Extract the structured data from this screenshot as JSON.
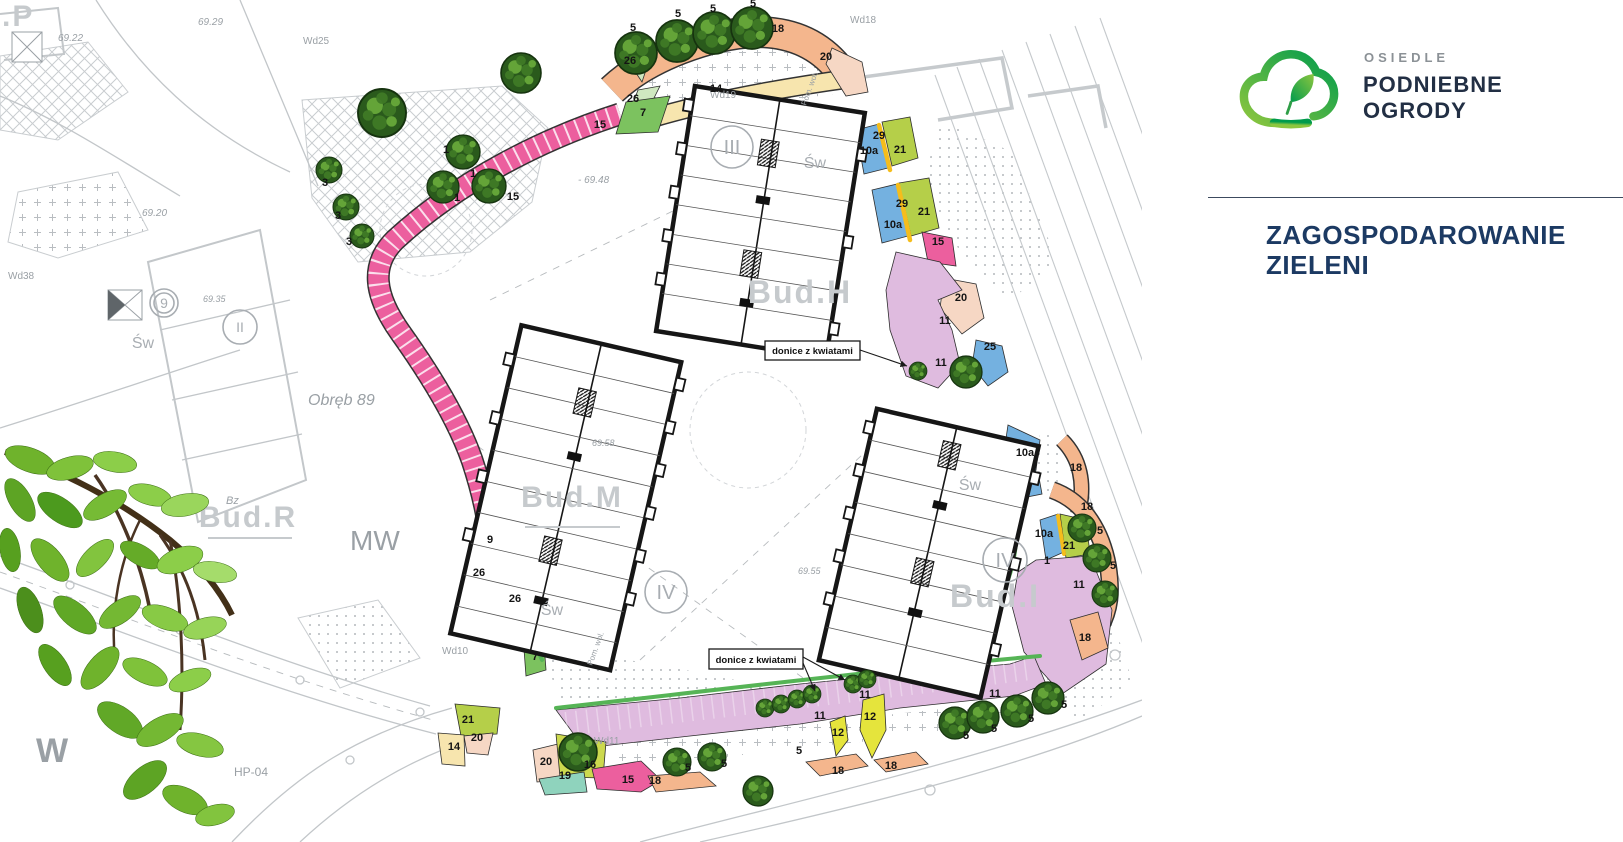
{
  "brand": {
    "estate_label": "OSIEDLE",
    "name_line1": "PODNIEBNE",
    "name_line2": "OGRODY",
    "title_line1": "ZAGOSPODAROWANIE",
    "title_line2": "ZIELENI",
    "colors": {
      "navy": "#222f44",
      "gray_text": "#8b9196",
      "title": "#1c3a63",
      "logo_green_light": "#8dc63f",
      "logo_green_dark": "#009b4c"
    }
  },
  "plan": {
    "sw_text": "Św",
    "zone_colors": {
      "7": "#7cc25f",
      "9": "#d6eedb",
      "10a": "#74b1e0",
      "11": "#dfbbdf",
      "12": "#e5e43c",
      "14": "#f7e5ae",
      "15": "#ec5f9e",
      "16": "#ccd94e",
      "18": "#f4b68d",
      "19": "#8fd3bd",
      "20": "#f6d7c4",
      "21": "#b5cf49",
      "25": "#74b1e0",
      "26": "#cfe8c0",
      "29": "#f5bd1c",
      "stripe_green": "#56b456"
    },
    "tree_colors": {
      "base": "#2a5a1c",
      "edge": "#16330f",
      "mid": "#3f7a26",
      "light": "#67a93a"
    },
    "building_labels": [
      {
        "t": "Bud.H",
        "x": 800,
        "y": 303,
        "s": 32
      },
      {
        "t": "Bud.M",
        "x": 572,
        "y": 507,
        "s": 30,
        "ul": [
          525,
          527,
          620,
          527
        ]
      },
      {
        "t": "Bud.I",
        "x": 995,
        "y": 607,
        "s": 32
      },
      {
        "t": "Bud.R",
        "x": 248,
        "y": 527,
        "s": 30,
        "ul": [
          208,
          538,
          292,
          538
        ]
      },
      {
        "t": "Bud.P",
        "x": -14,
        "y": 26,
        "s": 30,
        "st": 1
      }
    ],
    "circled_labels": [
      {
        "t": "III",
        "x": 732,
        "y": 147,
        "r": 21
      },
      {
        "t": "IV",
        "x": 666,
        "y": 592,
        "r": 21
      },
      {
        "t": "IV",
        "x": 1005,
        "y": 560,
        "r": 22
      },
      {
        "t": "II",
        "x": 240,
        "y": 327,
        "r": 17
      },
      {
        "t": "9",
        "x": 164,
        "y": 303,
        "r": 14
      }
    ],
    "sw_labels": [
      {
        "x": 815,
        "y": 168
      },
      {
        "x": 552,
        "y": 615
      },
      {
        "x": 970,
        "y": 490
      },
      {
        "x": 143,
        "y": 348
      }
    ],
    "gray_labels": [
      {
        "t": "69.22",
        "x": 58,
        "y": 41,
        "s": 10,
        "i": 1
      },
      {
        "t": "69.29",
        "x": 198,
        "y": 25,
        "s": 10,
        "i": 1
      },
      {
        "t": "69.20",
        "x": 142,
        "y": 216,
        "s": 10,
        "i": 1
      },
      {
        "t": "- 69.48",
        "x": 578,
        "y": 183,
        "s": 10,
        "i": 1
      },
      {
        "t": "69.35",
        "x": 203,
        "y": 302,
        "s": 9,
        "i": 1
      },
      {
        "t": "69.58",
        "x": 592,
        "y": 446,
        "s": 9,
        "i": 1
      },
      {
        "t": "69.55",
        "x": 798,
        "y": 574,
        "s": 9,
        "i": 1
      },
      {
        "t": "Wd25",
        "x": 303,
        "y": 44,
        "s": 10
      },
      {
        "t": "Wd38",
        "x": 8,
        "y": 279,
        "s": 10
      },
      {
        "t": "Wd18",
        "x": 850,
        "y": 23,
        "s": 10
      },
      {
        "t": "Wd19",
        "x": 710,
        "y": 98,
        "s": 10
      },
      {
        "t": "Wd10",
        "x": 442,
        "y": 654,
        "s": 10
      },
      {
        "t": "Wd11",
        "x": 594,
        "y": 744,
        "s": 10
      },
      {
        "t": "Obręb 89",
        "x": 308,
        "y": 405,
        "s": 16,
        "i": 1
      },
      {
        "t": "Bz",
        "x": 226,
        "y": 504,
        "s": 11,
        "i": 1
      },
      {
        "t": "MW",
        "x": 350,
        "y": 550,
        "s": 28
      },
      {
        "t": "W",
        "x": 36,
        "y": 762,
        "s": 34,
        "b": 1
      },
      {
        "t": "HP-04",
        "x": 234,
        "y": 776,
        "s": 12
      },
      {
        "t": "Pom. wol.",
        "x": 806,
        "y": 106,
        "s": 8,
        "r": -70
      },
      {
        "t": "Pom. wol.",
        "x": 592,
        "y": 666,
        "s": 8,
        "r": -70
      }
    ],
    "zone_labels": [
      {
        "z": "5",
        "x": 633,
        "y": 31
      },
      {
        "z": "5",
        "x": 678,
        "y": 17
      },
      {
        "z": "5",
        "x": 713,
        "y": 12
      },
      {
        "z": "5",
        "x": 753,
        "y": 7
      },
      {
        "z": "5",
        "x": 1100,
        "y": 534
      },
      {
        "z": "5",
        "x": 1113,
        "y": 569
      },
      {
        "z": "5",
        "x": 688,
        "y": 771
      },
      {
        "z": "5",
        "x": 724,
        "y": 767
      },
      {
        "z": "5",
        "x": 799,
        "y": 754
      },
      {
        "z": "5",
        "x": 966,
        "y": 739
      },
      {
        "z": "5",
        "x": 994,
        "y": 732
      },
      {
        "z": "5",
        "x": 1031,
        "y": 722
      },
      {
        "z": "5",
        "x": 1064,
        "y": 708
      },
      {
        "z": "3",
        "x": 325,
        "y": 186
      },
      {
        "z": "3",
        "x": 338,
        "y": 219
      },
      {
        "z": "3",
        "x": 349,
        "y": 245
      },
      {
        "z": "1",
        "x": 446,
        "y": 153
      },
      {
        "z": "1",
        "x": 473,
        "y": 177
      },
      {
        "z": "1",
        "x": 457,
        "y": 201
      },
      {
        "z": "1",
        "x": 1047,
        "y": 564
      },
      {
        "z": "18",
        "x": 778,
        "y": 32
      },
      {
        "z": "18",
        "x": 1076,
        "y": 471
      },
      {
        "z": "18",
        "x": 1087,
        "y": 510
      },
      {
        "z": "18",
        "x": 1085,
        "y": 641
      },
      {
        "z": "18",
        "x": 655,
        "y": 784
      },
      {
        "z": "18",
        "x": 838,
        "y": 774
      },
      {
        "z": "18",
        "x": 891,
        "y": 769
      },
      {
        "z": "20",
        "x": 826,
        "y": 60
      },
      {
        "z": "20",
        "x": 961,
        "y": 301
      },
      {
        "z": "20",
        "x": 477,
        "y": 741
      },
      {
        "z": "20",
        "x": 546,
        "y": 765
      },
      {
        "z": "14",
        "x": 716,
        "y": 92
      },
      {
        "z": "14",
        "x": 454,
        "y": 750
      },
      {
        "z": "7",
        "x": 643,
        "y": 116
      },
      {
        "z": "7",
        "x": 535,
        "y": 660
      },
      {
        "z": "15",
        "x": 600,
        "y": 128
      },
      {
        "z": "15",
        "x": 513,
        "y": 200
      },
      {
        "z": "15",
        "x": 938,
        "y": 245
      },
      {
        "z": "15",
        "x": 628,
        "y": 783
      },
      {
        "z": "26",
        "x": 630,
        "y": 64
      },
      {
        "z": "26",
        "x": 633,
        "y": 102
      },
      {
        "z": "26",
        "x": 479,
        "y": 576
      },
      {
        "z": "26",
        "x": 515,
        "y": 602
      },
      {
        "z": "29",
        "x": 879,
        "y": 139
      },
      {
        "z": "29",
        "x": 902,
        "y": 207
      },
      {
        "z": "10a",
        "x": 869,
        "y": 154
      },
      {
        "z": "10a",
        "x": 893,
        "y": 228
      },
      {
        "z": "10a",
        "x": 1025,
        "y": 456
      },
      {
        "z": "10a",
        "x": 1044,
        "y": 537
      },
      {
        "z": "21",
        "x": 900,
        "y": 153
      },
      {
        "z": "21",
        "x": 924,
        "y": 215
      },
      {
        "z": "21",
        "x": 1069,
        "y": 549
      },
      {
        "z": "21",
        "x": 468,
        "y": 723
      },
      {
        "z": "11",
        "x": 945,
        "y": 324
      },
      {
        "z": "11",
        "x": 941,
        "y": 366
      },
      {
        "z": "11",
        "x": 820,
        "y": 719
      },
      {
        "z": "11",
        "x": 865,
        "y": 698
      },
      {
        "z": "11",
        "x": 995,
        "y": 697
      },
      {
        "z": "11",
        "x": 1079,
        "y": 588
      },
      {
        "z": "12",
        "x": 838,
        "y": 736
      },
      {
        "z": "12",
        "x": 870,
        "y": 720
      },
      {
        "z": "16",
        "x": 590,
        "y": 768
      },
      {
        "z": "19",
        "x": 565,
        "y": 779
      },
      {
        "z": "25",
        "x": 990,
        "y": 350
      },
      {
        "z": "9",
        "x": 490,
        "y": 543
      }
    ],
    "trees": [
      {
        "x": 521,
        "y": 73,
        "r": 20
      },
      {
        "x": 636,
        "y": 53,
        "r": 21
      },
      {
        "x": 677,
        "y": 41,
        "r": 21
      },
      {
        "x": 714,
        "y": 33,
        "r": 21
      },
      {
        "x": 752,
        "y": 28,
        "r": 21
      },
      {
        "x": 382,
        "y": 113,
        "r": 24
      },
      {
        "x": 463,
        "y": 152,
        "r": 17
      },
      {
        "x": 443,
        "y": 187,
        "r": 16
      },
      {
        "x": 489,
        "y": 186,
        "r": 17
      },
      {
        "x": 329,
        "y": 170,
        "r": 13
      },
      {
        "x": 346,
        "y": 207,
        "r": 13
      },
      {
        "x": 362,
        "y": 236,
        "r": 12
      },
      {
        "x": 918,
        "y": 371,
        "r": 9
      },
      {
        "x": 966,
        "y": 372,
        "r": 16
      },
      {
        "x": 1082,
        "y": 528,
        "r": 14
      },
      {
        "x": 1097,
        "y": 558,
        "r": 14
      },
      {
        "x": 1105,
        "y": 594,
        "r": 13
      },
      {
        "x": 578,
        "y": 752,
        "r": 19
      },
      {
        "x": 765,
        "y": 708,
        "r": 9
      },
      {
        "x": 781,
        "y": 704,
        "r": 9
      },
      {
        "x": 797,
        "y": 699,
        "r": 9
      },
      {
        "x": 812,
        "y": 694,
        "r": 9
      },
      {
        "x": 853,
        "y": 684,
        "r": 9
      },
      {
        "x": 867,
        "y": 679,
        "r": 9
      },
      {
        "x": 677,
        "y": 762,
        "r": 14
      },
      {
        "x": 712,
        "y": 757,
        "r": 14
      },
      {
        "x": 758,
        "y": 791,
        "r": 15
      },
      {
        "x": 955,
        "y": 723,
        "r": 16
      },
      {
        "x": 983,
        "y": 717,
        "r": 16
      },
      {
        "x": 1017,
        "y": 711,
        "r": 16
      },
      {
        "x": 1048,
        "y": 698,
        "r": 16
      }
    ],
    "annotations": [
      {
        "text": "donice z kwiatami",
        "x": 765,
        "y": 341,
        "w": 95,
        "h": 19,
        "arrows": [
          [
            860,
            350,
            907,
            366
          ]
        ]
      },
      {
        "text": "donice z kwiatami",
        "x": 709,
        "y": 649,
        "w": 94,
        "h": 20,
        "arrows": [
          [
            803,
            657,
            845,
            680
          ],
          [
            803,
            663,
            815,
            691
          ]
        ]
      }
    ]
  }
}
